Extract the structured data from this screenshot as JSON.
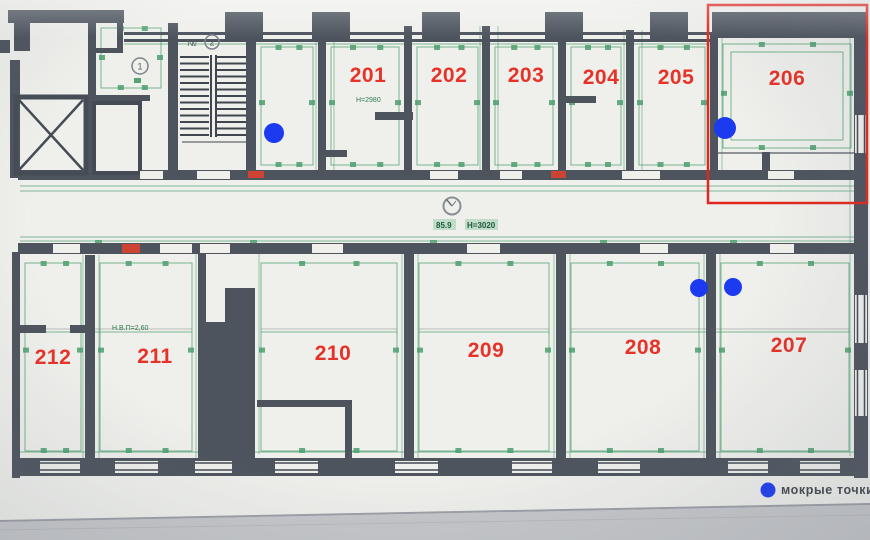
{
  "title": "floor plan photo",
  "colors": {
    "wall": "#4d545e",
    "wall_dark": "#424953",
    "green": "#2f8f57",
    "number": "#e63228",
    "wet": "#1c3bf0",
    "highlight": "#e02820",
    "paper": "#eff0ec",
    "door_marker": "#cd4435"
  },
  "rooms": [
    {
      "number": "201",
      "x": 368,
      "y": 75
    },
    {
      "number": "202",
      "x": 449,
      "y": 75
    },
    {
      "number": "203",
      "x": 526,
      "y": 75
    },
    {
      "number": "204",
      "x": 601,
      "y": 77
    },
    {
      "number": "205",
      "x": 676,
      "y": 77
    },
    {
      "number": "206",
      "x": 787,
      "y": 78
    },
    {
      "number": "207",
      "x": 789,
      "y": 345
    },
    {
      "number": "208",
      "x": 643,
      "y": 347
    },
    {
      "number": "209",
      "x": 486,
      "y": 350
    },
    {
      "number": "210",
      "x": 333,
      "y": 353
    },
    {
      "number": "211",
      "x": 155,
      "y": 356
    },
    {
      "number": "212",
      "x": 53,
      "y": 357
    }
  ],
  "annotations": {
    "room201_height": "Н=2980",
    "corridor_area": "85.9",
    "corridor_height": "Н=3020",
    "room211_note": "Н.В.П=2,60",
    "stair_mark": "№",
    "stair_circle": "2",
    "room_circle": "1"
  },
  "wet_points": [
    {
      "x": 274,
      "y": 133,
      "r": 10
    },
    {
      "x": 725,
      "y": 128,
      "r": 11
    },
    {
      "x": 699,
      "y": 288,
      "r": 9
    },
    {
      "x": 733,
      "y": 287,
      "r": 9
    }
  ],
  "highlight": {
    "x": 708,
    "y": 5,
    "w": 159,
    "h": 198
  },
  "legend": {
    "label": "мокрые точки",
    "x": 768,
    "y": 490
  }
}
